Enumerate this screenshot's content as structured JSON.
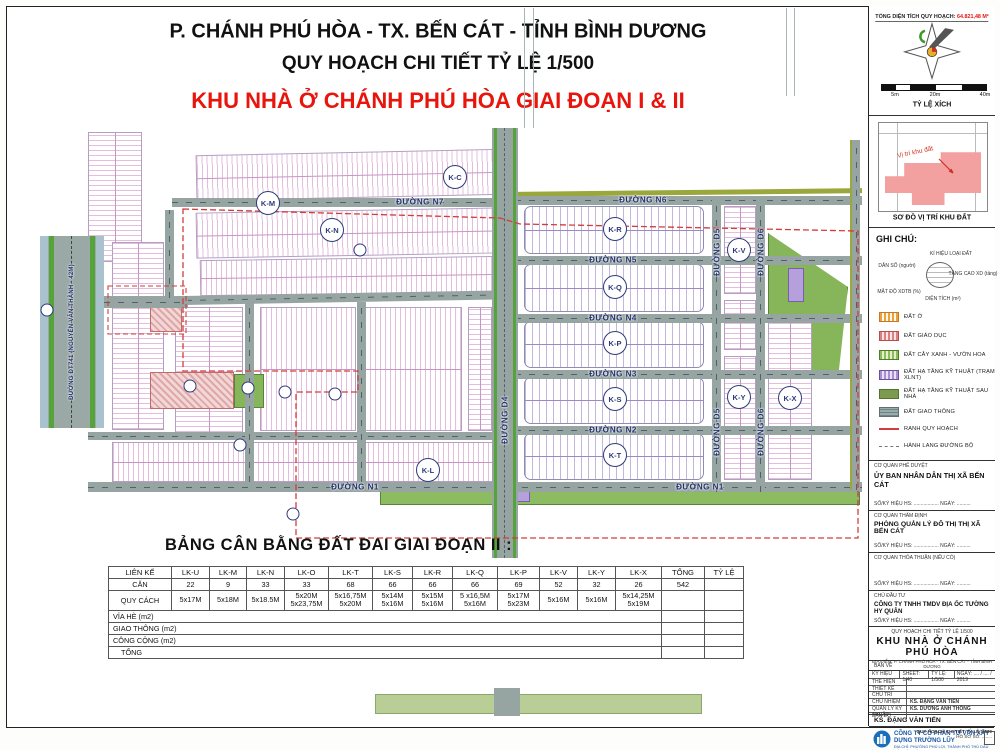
{
  "header": {
    "line1": "P. CHÁNH PHÚ HÒA - TX. BẾN CÁT - TỈNH BÌNH DƯƠNG",
    "line2": "QUY HOẠCH CHI TIẾT TỶ LỆ 1/500",
    "line3": "KHU NHÀ Ở CHÁNH PHÚ HÒA GIAI ĐOẠN I & II"
  },
  "colors": {
    "title_red": "#e8150d",
    "road_gray": "#96a5a2",
    "lot_purple": "#9c89c2",
    "boundary_red": "#d23c3c",
    "label_navy": "#22306b"
  },
  "top_right": {
    "total_area_label": "TỔNG DIỆN TÍCH QUY HOẠCH:",
    "total_area_value": "64.821,48 M²",
    "scale_ticks": {
      "t1": "5m",
      "t2": "20m",
      "t3": "40m"
    },
    "scale_caption": "TỶ LỆ XÍCH"
  },
  "location_map": {
    "site_label": "Vị trí khu đất",
    "caption": "SƠ ĐỒ VỊ TRÍ KHU ĐẤT"
  },
  "legend": {
    "title": "GHI CHÚ:",
    "key_diagram": {
      "top": "KÍ HIỆU LOẠI ĐẤT",
      "left": "DÂN SỐ (người)",
      "right": "TẦNG CAO XD (tầng)",
      "bottom_left": "MẬT ĐỘ XDTB (%)",
      "bottom": "DIỆN TÍCH (m²)"
    },
    "items": [
      {
        "label": "ĐẤT Ở"
      },
      {
        "label": "ĐẤT GIÁO DỤC"
      },
      {
        "label": "ĐẤT CÂY XANH - VƯỜN HOA"
      },
      {
        "label": "ĐẤT HẠ TẦNG KỸ THUẬT (TRẠM XLNT)"
      },
      {
        "label": "ĐẤT HẠ TẦNG KỸ THUẬT SAU NHÀ"
      },
      {
        "label": "ĐẤT GIAO THÔNG"
      },
      {
        "label": "RANH QUY HOẠCH"
      },
      {
        "label": "HÀNH LANG ĐƯỜNG BỘ"
      }
    ]
  },
  "map": {
    "streets": {
      "n7": "ĐƯỜNG N7",
      "n6": "ĐƯỜNG N6",
      "n5": "ĐƯỜNG N5",
      "n4": "ĐƯỜNG N4",
      "n3": "ĐƯỜNG N3",
      "n2": "ĐƯỜNG N2",
      "n1": "ĐƯỜNG N1",
      "d4": "ĐƯỜNG D4",
      "d5": "ĐƯỜNG D5",
      "d6": "ĐƯỜNG D6",
      "dt741": "ĐƯỜNG ĐT741 (NGUYỄN VĂN THÀNH - 42M)"
    },
    "blocks": {
      "km": "K-M",
      "kn": "K-N",
      "kc": "K-C",
      "kl": "K-L",
      "kr": "K-R",
      "kq": "K-Q",
      "kp": "K-P",
      "ks": "K-S",
      "kt": "K-T",
      "kv": "K-V",
      "ky": "K-Y",
      "kx": "K-X"
    }
  },
  "balance_table": {
    "title": "BẢNG CÂN BẰNG ĐẤT ĐAI GIAI ĐOẠN II :",
    "headers": [
      "LIÊN KẾ",
      "LK-U",
      "LK-M",
      "LK-N",
      "LK-O",
      "LK-T",
      "LK-S",
      "LK-R",
      "LK-Q",
      "LK-P",
      "LK-V",
      "LK-Y",
      "LK-X",
      "TỔNG",
      "TỶ LỆ"
    ],
    "row_can": {
      "label": "CĂN",
      "values": [
        "22",
        "9",
        "33",
        "33",
        "68",
        "66",
        "66",
        "66",
        "69",
        "52",
        "32",
        "26",
        "542",
        ""
      ]
    },
    "row_quycach": {
      "label": "QUY CÁCH",
      "values": [
        "5x17M",
        "5x18M",
        "5x18.5M",
        "5x20M\n5x23,75M",
        "5x16,75M\n5x20M",
        "5x14M\n5x16M",
        "5x15M\n5x16M",
        "5 x16,5M\n5x16M",
        "5x17M\n5x23M",
        "5x16M",
        "5x16M",
        "5x14,25M\n5x19M",
        "",
        ""
      ]
    },
    "row_viahe": "VỈA HÈ  (m2)",
    "row_giaothong": "GIAO THÔNG (m2)",
    "row_congcong": "CÔNG CỘNG (m2)",
    "row_tong": "TỔNG"
  },
  "title_block": {
    "approve_label": "CƠ QUAN PHÊ DUYỆT",
    "approve_name": "ỦY BAN NHÂN DÂN THỊ XÃ BẾN CÁT",
    "sign_line": "SỐ/KÝ HIỆU HS: ..................   NGÀY: ..........",
    "verify_label": "CƠ QUAN THẨM ĐỊNH",
    "verify_name": "PHÒNG QUẢN LÝ ĐÔ THỊ THỊ XÃ BẾN CÁT",
    "agree_label": "CƠ QUAN THỎA THUẬN (NẾU CÓ)",
    "investor_label": "CHỦ ĐẦU TƯ",
    "investor_name": "CÔNG TY TNHH TMDV ĐỊA ỐC TƯỜNG HY QUÂN",
    "project_type": "QUY HOẠCH CHI TIẾT TỶ LỆ 1/500",
    "project_name": "KHU NHÀ Ở CHÁNH PHÚ HÒA",
    "project_address": "ĐỊA ĐIỂM: P. CHÁNH PHÚ HÒA - TX. BẾN CÁT - TỈNH BÌNH DƯƠNG",
    "drawing_label": "BẢN VẼ",
    "kyhieu_label": "KÝ HIỆU",
    "sheet": "SHEET: 1/40",
    "scale": "TỶ LỆ: 1/500",
    "date": "NGÀY: .... / .... / 2019",
    "thehien": "THỂ HIỆN",
    "thietke": "THIẾT KẾ",
    "chutri": "CHỦ TRÌ",
    "chunhiem": "CHỦ NHIỆM",
    "chunhiem_value": "KS. ĐẶNG VĂN TIẾN",
    "qlkt": "QUẢN LÝ KỸ THUẬT",
    "qlkt_value": "KS. DƯƠNG ANH THÔNG",
    "bando": "BẢN ĐỒ",
    "engineer": "KS. ĐẶNG VĂN TIẾN",
    "company": "CÔNG TY CỔ PHẦN TƯ VẤN XÂY DỰNG TRƯỜNG LŨY",
    "company_address": "ĐỊA CHỈ: PHƯỜNG PHÚ LỢI, THÀNH PHỐ THỦ DẦU MỘT, TỈNH BÌNH DƯƠNG",
    "footer_line1": "QUY HOẠCH CHI TIẾT TỶ LỆ 1/500",
    "footer_line2": "HỒ SƠ SỐ: ........"
  }
}
